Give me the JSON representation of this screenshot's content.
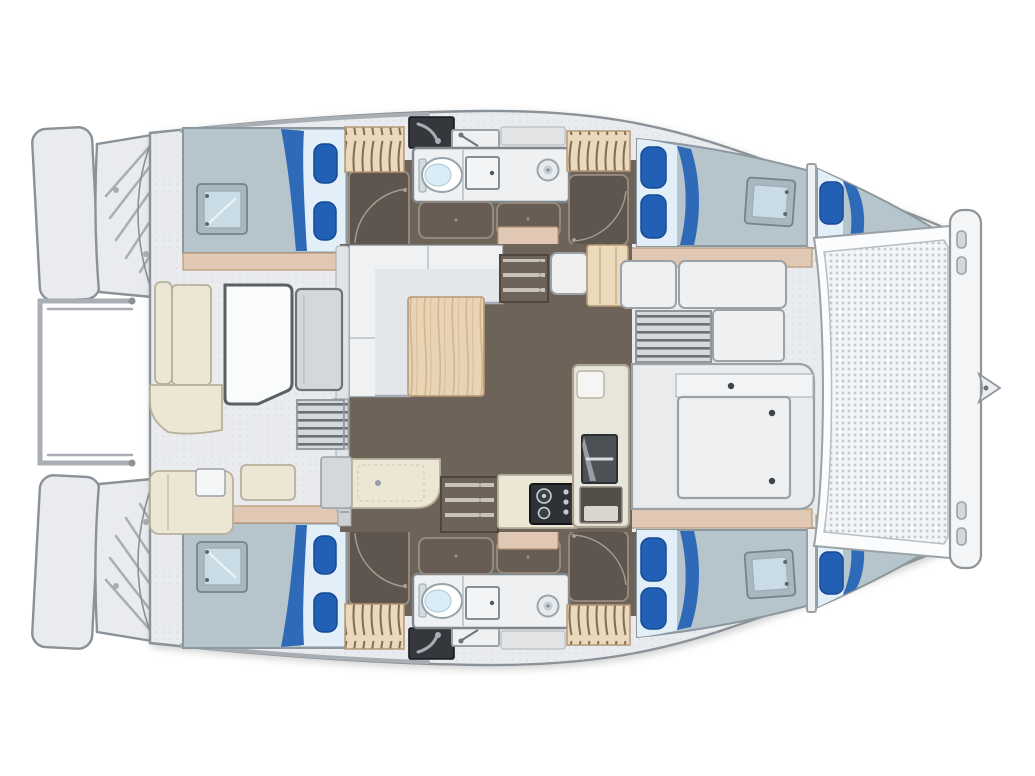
{
  "figure": {
    "type": "catamaran-floor-plan-top-view",
    "orientation": "bow-right-stern-left",
    "symmetry": "mirrored-port-starboard"
  },
  "features": {
    "berths": [
      "aft-cabin-double-port",
      "aft-cabin-double-starboard",
      "forward-cabin-double-port",
      "forward-cabin-double-starboard",
      "forepeak-berth-port",
      "forepeak-berth-starboard"
    ],
    "heads": [
      "bathroom-port",
      "bathroom-starboard"
    ],
    "living": [
      "saloon-l-sofa",
      "saloon-table",
      "galley-sink-counter",
      "galley-stove",
      "galley-fridge-unit",
      "companionway-steps-port",
      "companionway-steps-starboard"
    ],
    "exterior": [
      "aft-cockpit-table",
      "cockpit-u-seating",
      "cockpit-bench",
      "swim-platforms",
      "transom-steps",
      "davit-rail",
      "foredeck-lockers",
      "deck-vent-grilles",
      "bow-trampoline",
      "forward-crossbeam",
      "bowsprit-fitting"
    ]
  },
  "palette": {
    "background": "#ffffff",
    "deck": "#e9ebee",
    "deck-stroke": "#8a9197",
    "panel": "#eef0f2",
    "panel-stroke": "#9aa1a7",
    "floor": "#6e6359",
    "floor-stroke": "#4e463f",
    "cabinet-dark": "#5e554e",
    "cabinet-stroke": "#988d82",
    "arc-stroke": "#a89d92",
    "wood-tan": "#e0c8b4",
    "wood-light": "#ead9bb",
    "wood-stroke": "#b69877",
    "wood-table": "#e8d4b4",
    "grain-stroke": "#d2b68f",
    "cream": "#ece6d4",
    "cream-stroke": "#b7b09a",
    "mattress": "#b6c4cb",
    "sheet": "#e2eff8",
    "bed-stroke": "#8c98a0",
    "pillow": "#2160b4",
    "pillow-stroke": "#174a94",
    "blanket": "#2e6ab8",
    "hatch-frame": "#a9b7bf",
    "hatch-glass": "#c9dbe5",
    "bath-floor": "#eef0f1",
    "bath-stroke": "#7d858c",
    "toilet-bowl": "#d8edf7",
    "dark-box": "#34383c",
    "steel": "#a8aeb3",
    "sofa": "#e4e7ea",
    "sofa-light": "#eff1f3",
    "sofa-stroke": "#a6adb2",
    "white": "#fbfcfd",
    "mesh-bg": "#f4f5f6",
    "mesh-dot": "#c6cacd",
    "table-white": "#fafbfb",
    "table-stroke": "#5a5f63",
    "grille": "#d5d8db",
    "grille-slat": "#6a7076",
    "tread": "#c9c2b6",
    "stipple-dot": "#c7cbcf"
  }
}
